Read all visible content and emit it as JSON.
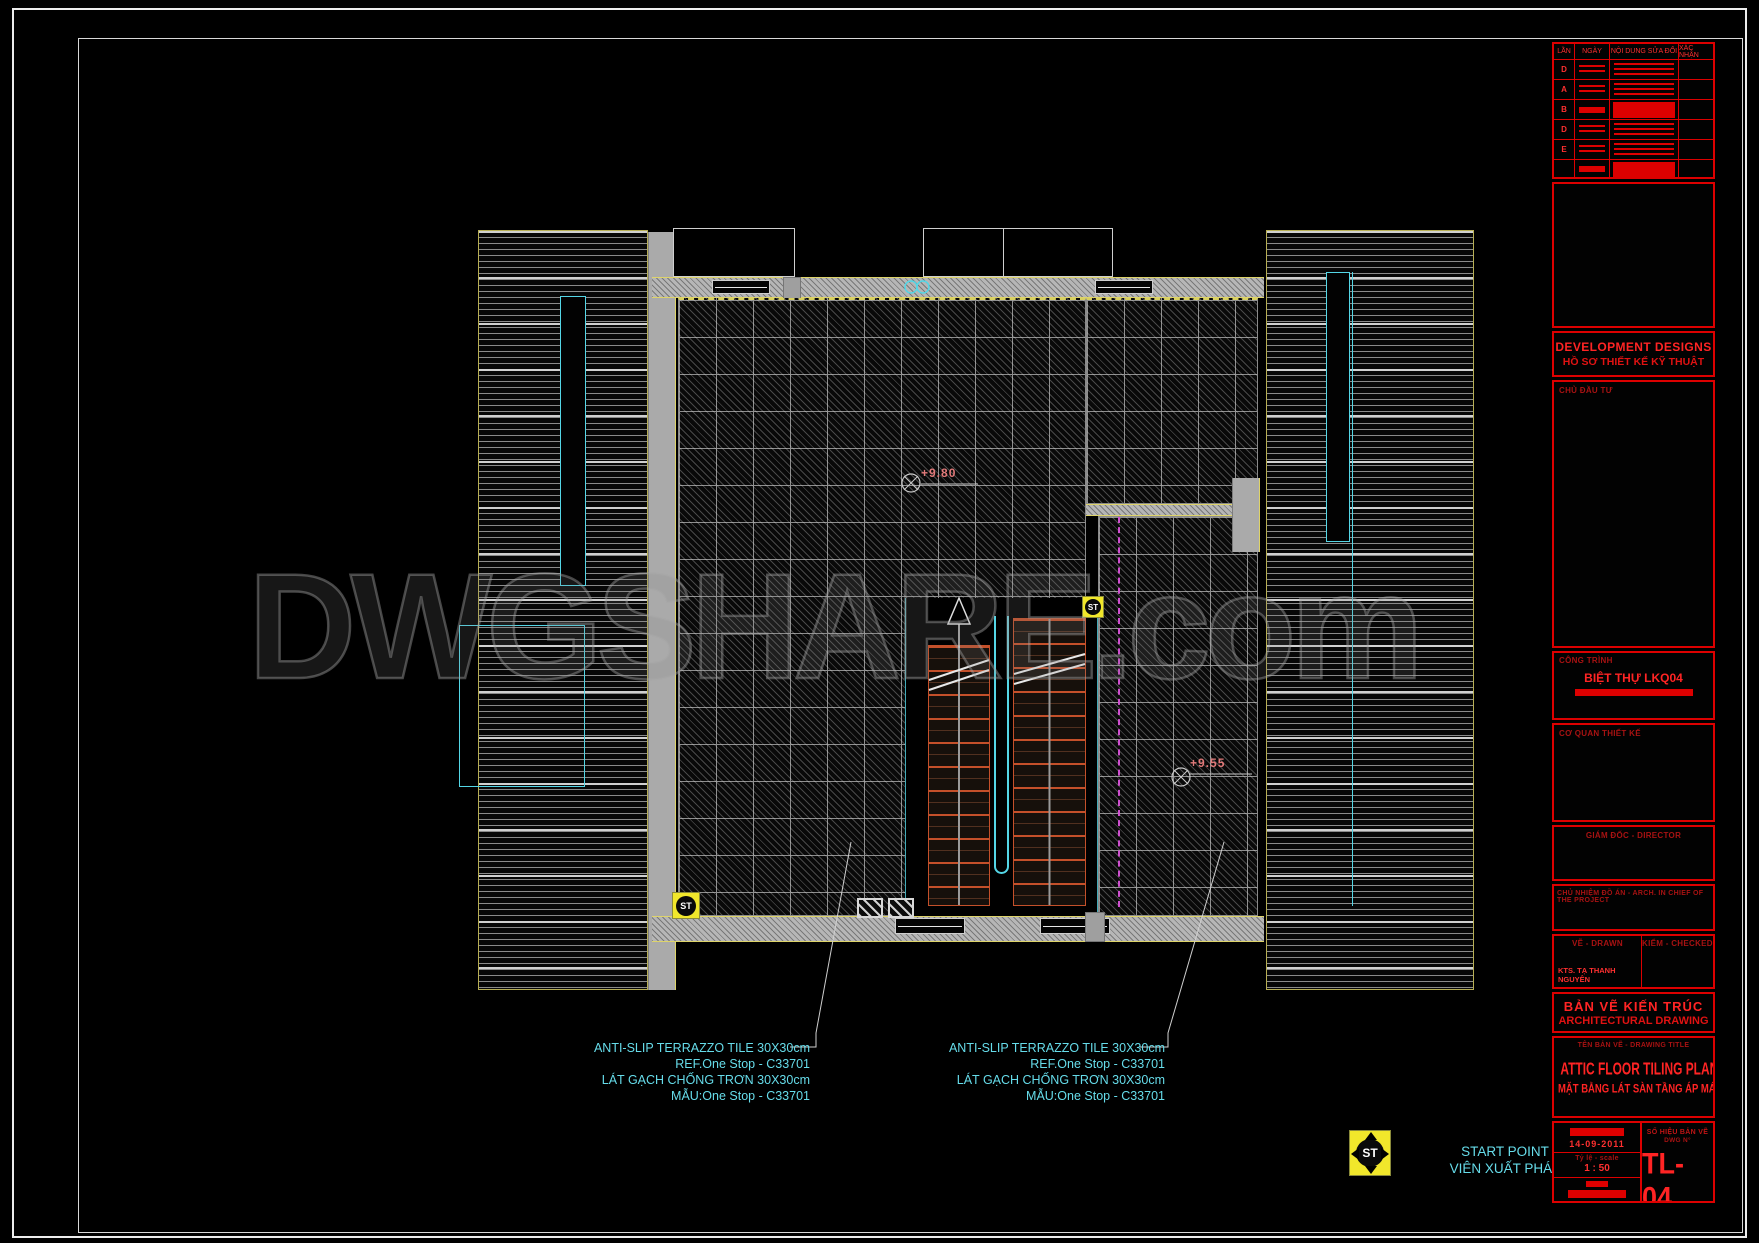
{
  "sheet": {
    "watermark": "DWGSHARE.com"
  },
  "title_block": {
    "revision_table": {
      "headers": [
        "LẦN",
        "NGÀY",
        "NỘI DUNG SỬA ĐỔI",
        "XÁC NHẬN"
      ],
      "rows": [
        {
          "label": "D"
        },
        {
          "label": "A"
        },
        {
          "label": "B"
        },
        {
          "label": "D"
        },
        {
          "label": "E"
        },
        {
          "label": ""
        }
      ]
    },
    "firm_en": "DEVELOPMENT DESIGNS",
    "firm_vi": "HỒ SƠ THIẾT KẾ KỸ THUẬT",
    "client_label": "CHỦ ĐẦU TƯ",
    "project_label": "CÔNG TRÌNH",
    "project_name": "BIỆT THỰ LKQ04",
    "design_office_label": "CƠ QUAN THIẾT KẾ",
    "director_label": "GIÁM ĐỐC - DIRECTOR",
    "chief_label": "CHỦ NHIỆM ĐỒ ÁN - ARCH. IN CHIEF OF THE PROJECT",
    "drawn_label": "VẼ - DRAWN",
    "checked_label": "KIỂM - CHECKED",
    "drawn_by": "KTS. TẠ THANH NGUYÊN",
    "category_vi": "BẢN VẼ KIẾN TRÚC",
    "category_en": "ARCHITECTURAL DRAWING",
    "title_label": "TÊN BẢN VẼ - DRAWING TITLE",
    "title_en": "ATTIC FLOOR TILING PLAN",
    "title_vi": "MẶT BẰNG LÁT SÀN TẦNG ÁP MÁI",
    "date": "14-09-2011",
    "scale_label": "Tỷ lệ - scale",
    "scale_value": "1 : 50",
    "number_label": "SỐ HIỆU BẢN VẼ",
    "number_sublabel": "DWG N°",
    "drawing_number": "TL-04"
  },
  "plan": {
    "levels": [
      {
        "value": "+9.80"
      },
      {
        "value": "+9.55"
      }
    ],
    "annotations": [
      {
        "lines": [
          "ANTI-SLIP TERRAZZO TILE 30X30cm",
          "REF.One Stop - C33701",
          "LÁT GẠCH CHỐNG TRƠN 30X30cm",
          "MẪU:One Stop - C33701"
        ]
      },
      {
        "lines": [
          "ANTI-SLIP TERRAZZO TILE 30X30cm",
          "REF.One Stop - C33701",
          "LÁT GẠCH CHỐNG TRƠN 30X30cm",
          "MẪU:One Stop - C33701"
        ]
      }
    ],
    "start_point": {
      "symbol": "ST",
      "label_en": "START POINT",
      "label_vi": "VIÊN XUẤT PHÁT"
    },
    "colors": {
      "annotation": "#66dcea",
      "title_red": "#ff2424",
      "wall_yellow": "#ded46a",
      "step_red": "#c4502a",
      "magenta": "#cf4fcf"
    }
  }
}
